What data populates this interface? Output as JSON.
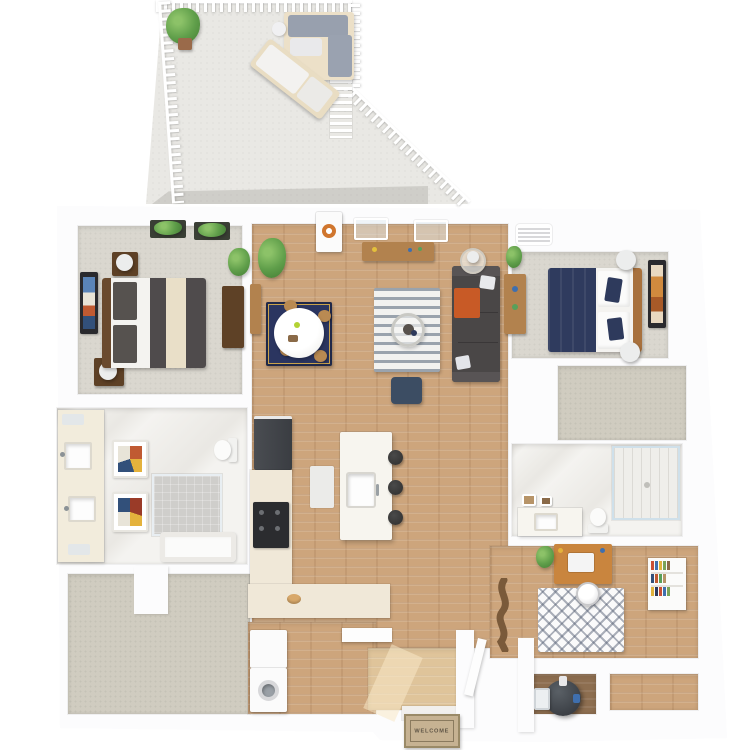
{
  "scene_type": "3d-floor-plan-rendering",
  "welcome_mat": {
    "text": "WELCOME"
  },
  "palette": {
    "background": "#ffffff",
    "wall_white": "#fcfcfd",
    "wood_floor": "#cda57c",
    "entry_wood_light": "#dfc49a",
    "utility_wood_dark": "#8d6e50",
    "bedroom_carpet": "#dad7cf",
    "closet_carpet": "#d0ccc0",
    "patio_concrete": "#e9e8e4",
    "marble_tile": "#f4f3f0",
    "sofa_charcoal": "#4a4747",
    "accent_orange": "#c85a26",
    "navy": "#2e3a5c",
    "counter_cream": "#f0e8d8",
    "island_white": "#f7f5ef",
    "desk_oak": "#c9853e",
    "appliance_dark": "#3c3f44",
    "plant_green": "#5f9e4a",
    "railing_white": "#ffffff",
    "mat_tan": "#c6b292"
  },
  "rooms": [
    {
      "name": "patio",
      "furniture": [
        "outdoor-sectional-sofa",
        "chaise-lounge",
        "potted-plant",
        "privacy-screen",
        "white-railing"
      ]
    },
    {
      "name": "bedroom-1",
      "furniture": [
        "queen-bed-striped-bedding",
        "nightstand-with-lamp",
        "nightstand-with-lamp",
        "dresser",
        "wall-art",
        "window-planter",
        "window-planter",
        "potted-plant"
      ]
    },
    {
      "name": "living-room",
      "furniture": [
        "charcoal-sofa",
        "orange-throw-blanket",
        "round-coffee-table",
        "striped-area-rug",
        "floor-lamp-side-table",
        "media-console",
        "navy-pouf",
        "patio-door-with-wreath",
        "potted-plant"
      ]
    },
    {
      "name": "dining-area",
      "furniture": [
        "round-white-table",
        "dining-chairs-x4",
        "navy-rug",
        "sideboard"
      ]
    },
    {
      "name": "kitchen",
      "furniture": [
        "refrigerator",
        "range-oven",
        "kitchen-island-with-sink",
        "bar-stools-x3",
        "l-shaped-counter",
        "counter-bowl"
      ]
    },
    {
      "name": "bathroom-1",
      "furniture": [
        "double-vanity",
        "two-sinks",
        "walk-in-shower",
        "toilet",
        "bathtub",
        "mosaic-wall-art-x2"
      ]
    },
    {
      "name": "walk-in-closet-1",
      "furniture": []
    },
    {
      "name": "bedroom-2",
      "furniture": [
        "queen-bed-navy-bedding",
        "floor-lamp",
        "floor-lamp",
        "desk",
        "wall-art",
        "ceiling-vent",
        "potted-plant"
      ]
    },
    {
      "name": "walk-in-closet-2",
      "furniture": []
    },
    {
      "name": "bathroom-2",
      "furniture": [
        "vanity-with-sink",
        "toilet",
        "glass-shower",
        "small-wall-art"
      ]
    },
    {
      "name": "den-office",
      "furniture": [
        "oak-desk",
        "laptop",
        "desk-chair",
        "chevron-rug",
        "bookshelf",
        "potted-plant",
        "driftwood-decor"
      ]
    },
    {
      "name": "laundry-closet",
      "furniture": [
        "stacked-washer-dryer",
        "floating-shelf"
      ]
    },
    {
      "name": "utility-closet",
      "furniture": [
        "water-heater",
        "electrical-panel"
      ]
    },
    {
      "name": "entry",
      "furniture": [
        "front-door",
        "welcome-mat"
      ]
    }
  ]
}
